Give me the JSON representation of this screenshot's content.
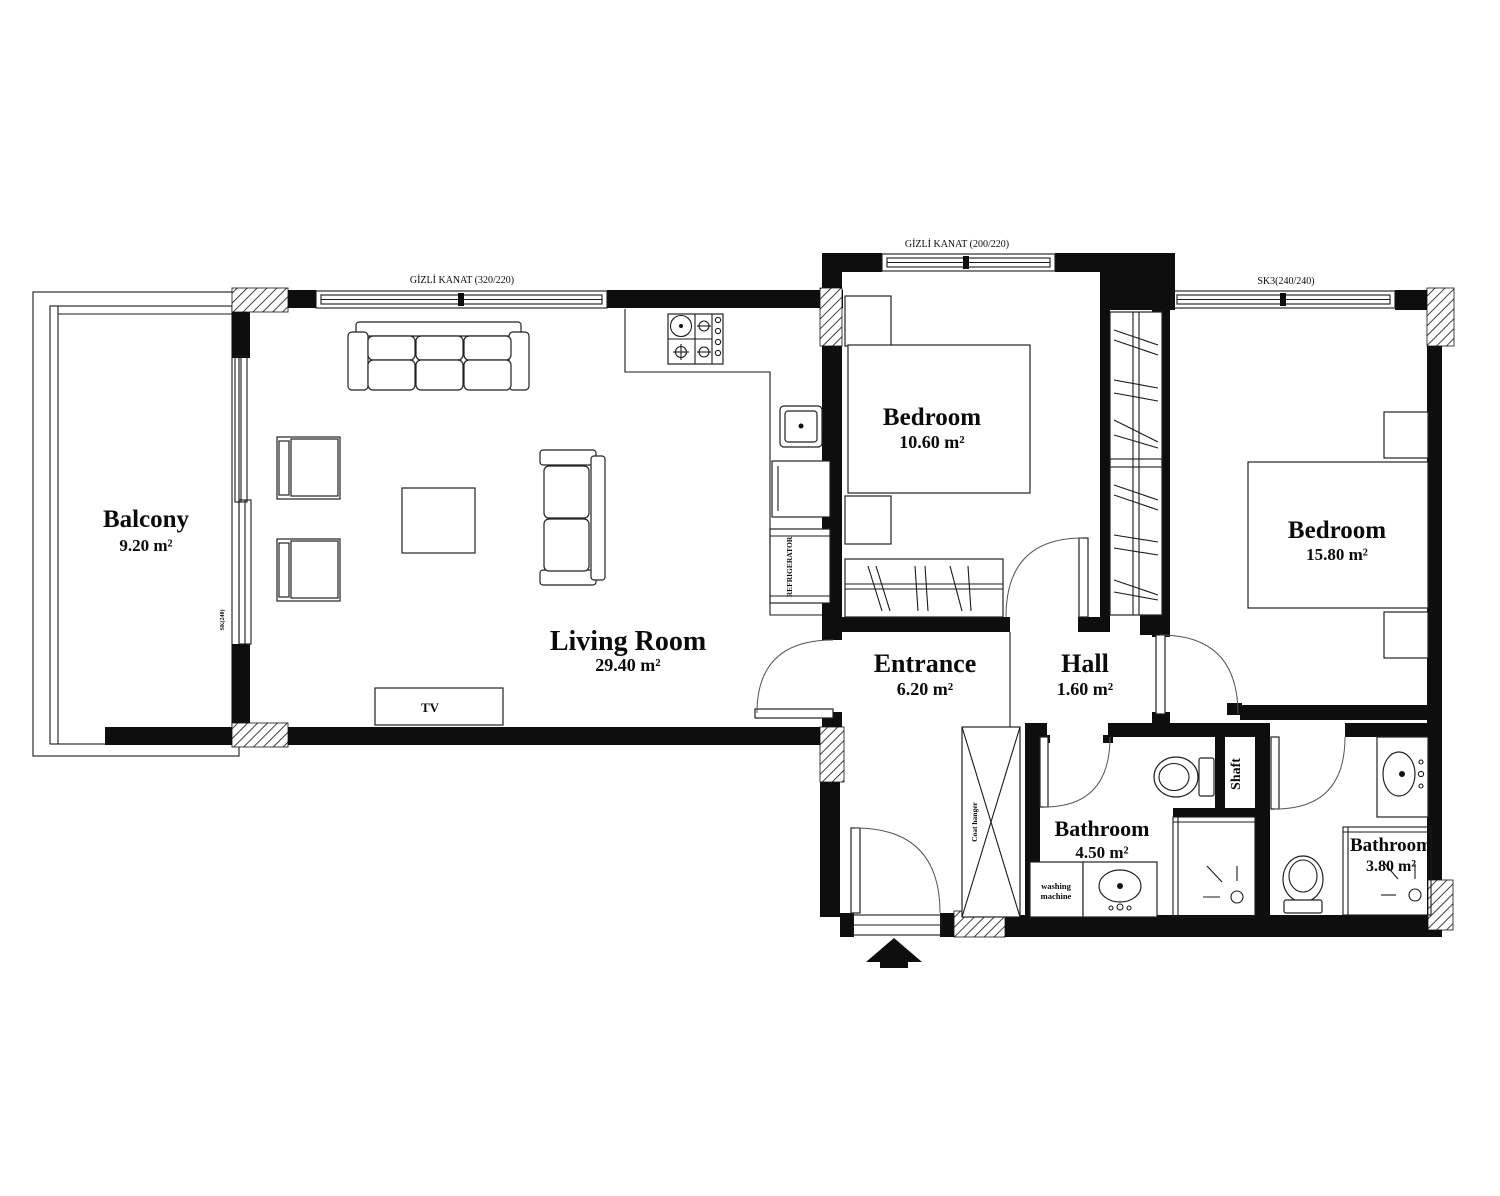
{
  "rooms": {
    "balcony": {
      "name": "Balcony",
      "area": "9.20 m²"
    },
    "living_room": {
      "name": "Living Room",
      "area": "29.40 m²"
    },
    "bedroom_1": {
      "name": "Bedroom",
      "area": "10.60 m²"
    },
    "bedroom_2": {
      "name": "Bedroom",
      "area": "15.80 m²"
    },
    "entrance": {
      "name": "Entrance",
      "area": "6.20 m²"
    },
    "hall": {
      "name": "Hall",
      "area": "1.60 m²"
    },
    "bathroom_1": {
      "name": "Bathroom",
      "area": "4.50 m²"
    },
    "bathroom_2": {
      "name": "Bathroom",
      "area": "3.80 m²"
    },
    "shaft": {
      "name": "Shaft"
    }
  },
  "fixtures": {
    "tv": "TV",
    "refrigerator": "REFRIGERATOR",
    "washing_machine_line1": "washing",
    "washing_machine_line2": "machine",
    "coat_hanger": "Coat hanger"
  },
  "windows": {
    "living_room": "GİZLİ KANAT (320/220)",
    "bedroom_1": "GİZLİ KANAT (200/220)",
    "bedroom_2": "SK3(240/240)",
    "balcony_door": "SK(240)"
  },
  "colors": {
    "line": "#0e0e0e",
    "background": "#ffffff"
  }
}
